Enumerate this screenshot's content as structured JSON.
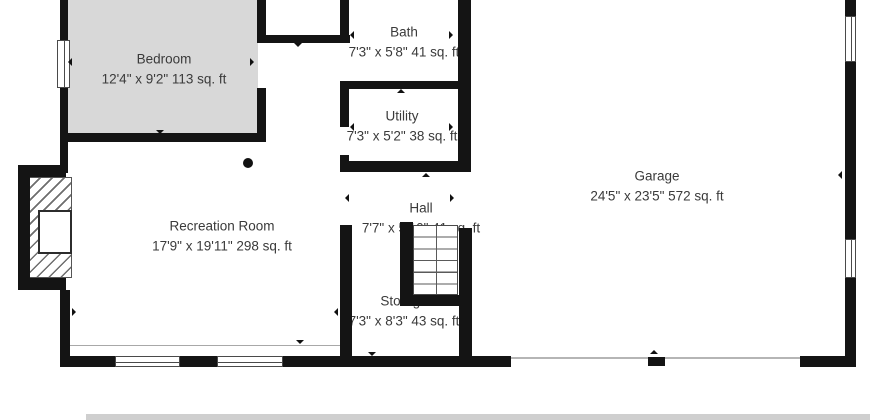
{
  "floorplan": {
    "type": "basement-floor-plan",
    "rooms": [
      {
        "id": "bedroom",
        "name": "Bedroom",
        "dims": "12'4\" x 9'2\" 113 sq. ft"
      },
      {
        "id": "bath",
        "name": "Bath",
        "dims": "7'3\" x 5'8\" 41 sq. ft"
      },
      {
        "id": "utility",
        "name": "Utility",
        "dims": "7'3\" x 5'2\" 38 sq. ft"
      },
      {
        "id": "hall",
        "name": "Hall",
        "dims": "7'7\" x 5'10\" 41 sq. ft"
      },
      {
        "id": "recreation",
        "name": "Recreation Room",
        "dims": "17'9\" x 19'11\" 298 sq. ft"
      },
      {
        "id": "storage",
        "name": "Storage",
        "dims": "7'3\" x 8'3\" 43 sq. ft"
      },
      {
        "id": "garage",
        "name": "Garage",
        "dims": "24'5\" x 23'5\" 572 sq. ft"
      }
    ],
    "colors": {
      "wall": "#141414",
      "bedroom_fill": "#d8d8d8",
      "label_text": "#3a3a3a",
      "background": "#ffffff"
    }
  }
}
